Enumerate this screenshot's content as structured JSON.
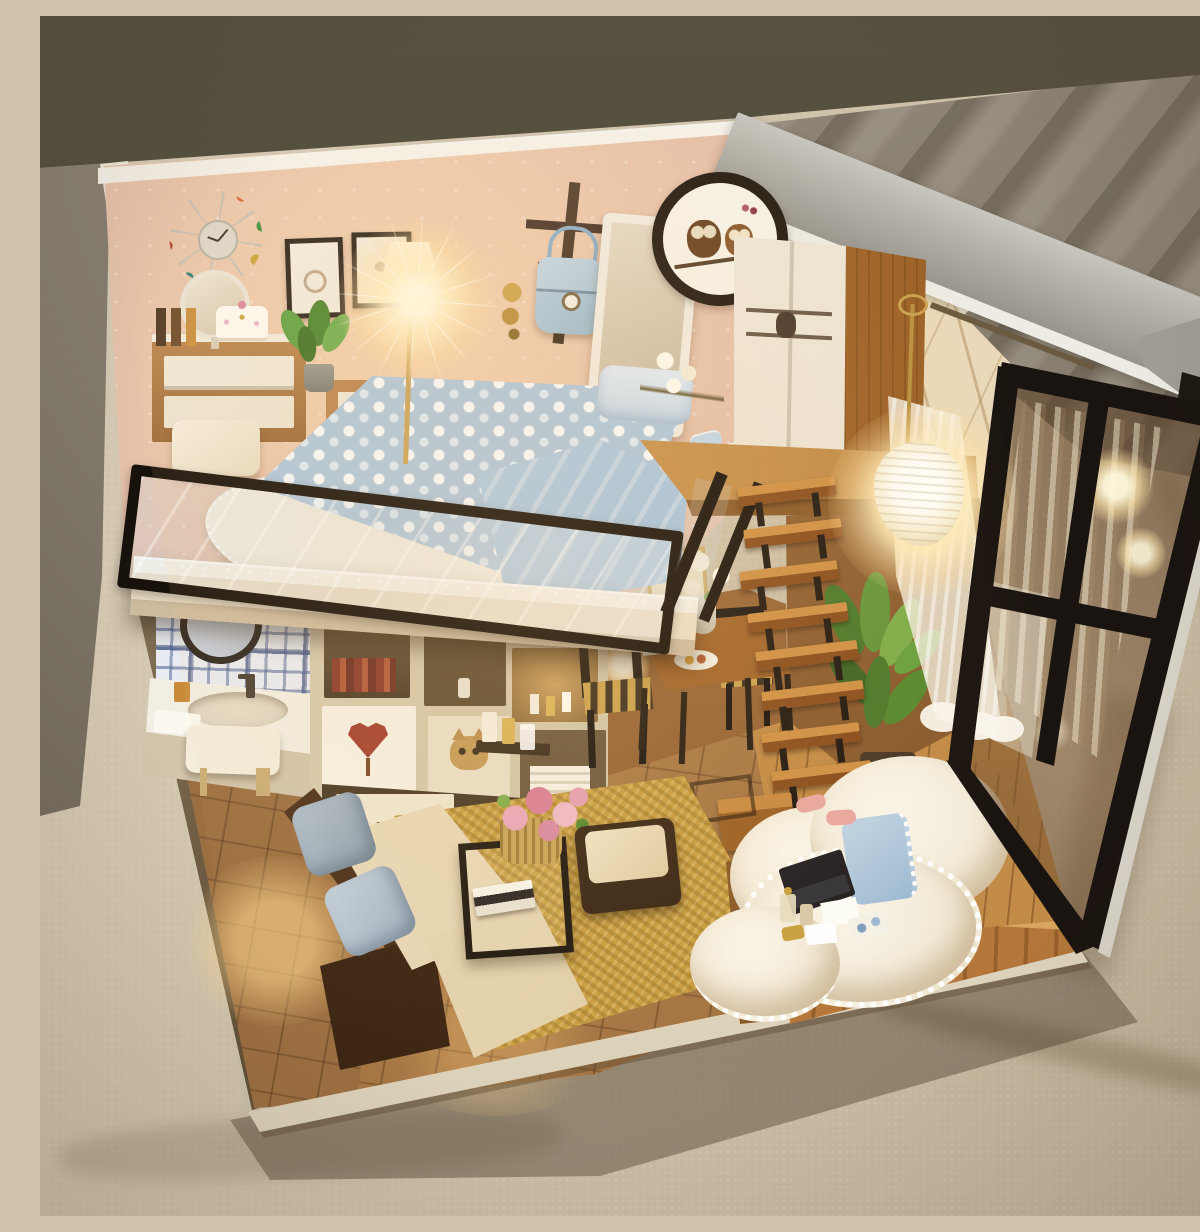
{
  "meta": {
    "type": "photograph",
    "subject": "DIY miniature dollhouse — modern loft apartment diorama",
    "description": "Handcrafted DIY miniature dollhouse diorama of a two-level loft apartment, warmly lit from inside, displayed on a beige carpet against a dark taupe backdrop. Upper loft bedroom with bed, vanity and glowing floor lamp behind a glass railing; open living area below with sofa, shelving, bathroom nook, dining set, floating wooden stairs, glowing pendant lamp and a black-framed glass wall under a slanted grey roof slab."
  },
  "environment": {
    "backdrop_wall_color": "#4f4a3c",
    "fabric_fold_color": "#8a8172",
    "carpet_color": "#cfc2aa",
    "shadow_color": "rgba(72,58,40,0.42)"
  },
  "house": {
    "structure": {
      "roof": {
        "label": "slanted concrete-grey roof slab",
        "color": "#b2afa8",
        "edge_color": "#edebe4"
      },
      "back_wall": {
        "label": "rose-beige sparkle wallpaper",
        "color": "#d9b2a0"
      },
      "ceiling_color": "#f4efe5",
      "left_wall_edge_color": "#e9e2d2",
      "branch_print_wall_color": "#ead9b8",
      "glass_wall": {
        "label": "black framed floor-to-ceiling window",
        "frame_color": "#1a1410",
        "trim_color": "#d8d3c8"
      },
      "loft_slab_color": "#ecdfc7",
      "railing": {
        "label": "glass loft railing with black frame",
        "frame_color": "#17110b"
      },
      "base_color": "#f1ead9"
    },
    "loft_bedroom": {
      "label": "upper loft bedroom",
      "objects": [
        {
          "name": "sunburst wall clock",
          "colors": [
            "#b3392b",
            "#d4652a",
            "#3f8f3f",
            "#33302b",
            "#2e7f72",
            "#caa43a"
          ]
        },
        {
          "name": "two framed bird sketches",
          "frame_color": "#2d251c"
        },
        {
          "name": "glowing floor lamp",
          "glow_color": "#fff3cf"
        },
        {
          "name": "double bed with pebble-print blue duvet",
          "colors": [
            "#aec7dd",
            "#fafdff"
          ]
        },
        {
          "name": "light blue satin throw",
          "color": "#a2c2de"
        },
        {
          "name": "blue pillow",
          "color": "#c6d8e8"
        },
        {
          "name": "white lace bedside rug",
          "color": "#f6f0e2"
        },
        {
          "name": "vanity dresser with round mirror",
          "colors": [
            "#b9854e",
            "#efe8d8"
          ]
        },
        {
          "name": "three-drawer chest",
          "colors": [
            "#b9854e",
            "#efe8d8"
          ]
        },
        {
          "name": "dotted cream cake",
          "color": "#fdfaf2"
        },
        {
          "name": "perfume bottles",
          "colors": [
            "#503823",
            "#c98f3f"
          ]
        },
        {
          "name": "potted green plant",
          "color": "#61a143"
        },
        {
          "name": "white vanity stool",
          "color": "#f6efdf"
        },
        {
          "name": "wall coat rack with light-blue handbag",
          "bag_color": "#aac6dd"
        },
        {
          "name": "gold bird wall ornament",
          "color": "#cda44e"
        },
        {
          "name": "standing dress mirror",
          "frame_color": "#f1ece1"
        },
        {
          "name": "round owl-couple wall art",
          "ring_color": "#241b12",
          "owl_colors": [
            "#6b4423",
            "#8a5a2e"
          ]
        },
        {
          "name": "white wardrobe with scroll decal",
          "colors": [
            "#f5efe3",
            "#6b5a48"
          ]
        },
        {
          "name": "wood wardrobe door",
          "color": "#a5692a"
        },
        {
          "name": "pair of blue slippers",
          "color": "#c3d8ea"
        },
        {
          "name": "white flowers by the railing",
          "color": "#fdfaf0"
        }
      ]
    },
    "ground_floor": {
      "label": "open living area",
      "objects": [
        {
          "name": "bathroom nook with blue plaid tiles",
          "tile_color": "#48548c"
        },
        {
          "name": "round black-frame bathroom mirror",
          "color": "#2c2721"
        },
        {
          "name": "white wash basin with faucet",
          "color": "#f2eee2"
        },
        {
          "name": "small white bench stool",
          "color": "#f4eddc"
        },
        {
          "name": "cream cube shelving unit",
          "color": "#d3c7aa"
        },
        {
          "name": "heart-tree framed art",
          "heart_color": "#a3402f"
        },
        {
          "name": "cat figurine",
          "color": "#c49a58"
        },
        {
          "name": "mini bar bottles and glasses",
          "colors": [
            "#f4efe2",
            "#d9b45a"
          ]
        },
        {
          "name": "glowing ball lamps",
          "glow_color": "#fff3cf"
        },
        {
          "name": "polka-dot wall hanging",
          "color": "#efe6d0"
        },
        {
          "name": "framed botanical print",
          "frame_color": "#c9a45c"
        },
        {
          "name": "L-shaped sofa, brown leather with cream cushions",
          "colors": [
            "#4a2f1b",
            "#f0e3c2"
          ]
        },
        {
          "name": "two grey-blue throw pillows",
          "colors": [
            "#9fb0bf",
            "#c6d2dd"
          ]
        },
        {
          "name": "black-frame glass coffee table",
          "color": "#211a12"
        },
        {
          "name": "wicker basket of pink roses",
          "colors": [
            "#c9a558",
            "#e9a8bc"
          ]
        },
        {
          "name": "stacked books",
          "colors": [
            "#f7f3e8",
            "#2e2a26"
          ]
        },
        {
          "name": "woven jute rug",
          "color": "#c89e42"
        },
        {
          "name": "dark ottoman with cream top",
          "colors": [
            "#3a2817",
            "#f0e4c6"
          ]
        },
        {
          "name": "wooden dining table with white flowers and breakfast plate",
          "color": "#a5682f"
        },
        {
          "name": "two black chairs with striped woven seats",
          "stripe_colors": [
            "#caa24e",
            "#3c2f1e"
          ]
        },
        {
          "name": "floating wooden staircase with black supports",
          "colors": [
            "#cf9146",
            "#221a12"
          ]
        },
        {
          "name": "tall green plant",
          "color": "#4c7a2b"
        },
        {
          "name": "glowing pendant lamp with crinkled white shade",
          "glow_color": "#fff6d6"
        },
        {
          "name": "white sheer curtains with branch pattern",
          "color": "#f6f1e5"
        },
        {
          "name": "wooden platform daybed",
          "color": "#b5773a"
        },
        {
          "name": "white fluffy pompom blanket",
          "color": "#f7f1e1"
        },
        {
          "name": "blue pompom cushion",
          "color": "#adc6dd"
        },
        {
          "name": "black laptop",
          "color": "#232022"
        },
        {
          "name": "scattered cards, perfume bottles and gold trinket",
          "colors": [
            "#fdfdf8",
            "#c9a040"
          ]
        },
        {
          "name": "pink slippers",
          "color": "#e8a8a0"
        },
        {
          "name": "brown tile floor",
          "color": "#a97c4c"
        },
        {
          "name": "wood plank floor by stairs",
          "color": "#c28b47"
        }
      ]
    },
    "lighting": {
      "mood": "warm evening glow",
      "sources": [
        "floor lamp",
        "pendant lamp",
        "ball lamps",
        "hidden floor glow",
        "window reflections"
      ],
      "glow_color": "#ffe9b8"
    }
  }
}
